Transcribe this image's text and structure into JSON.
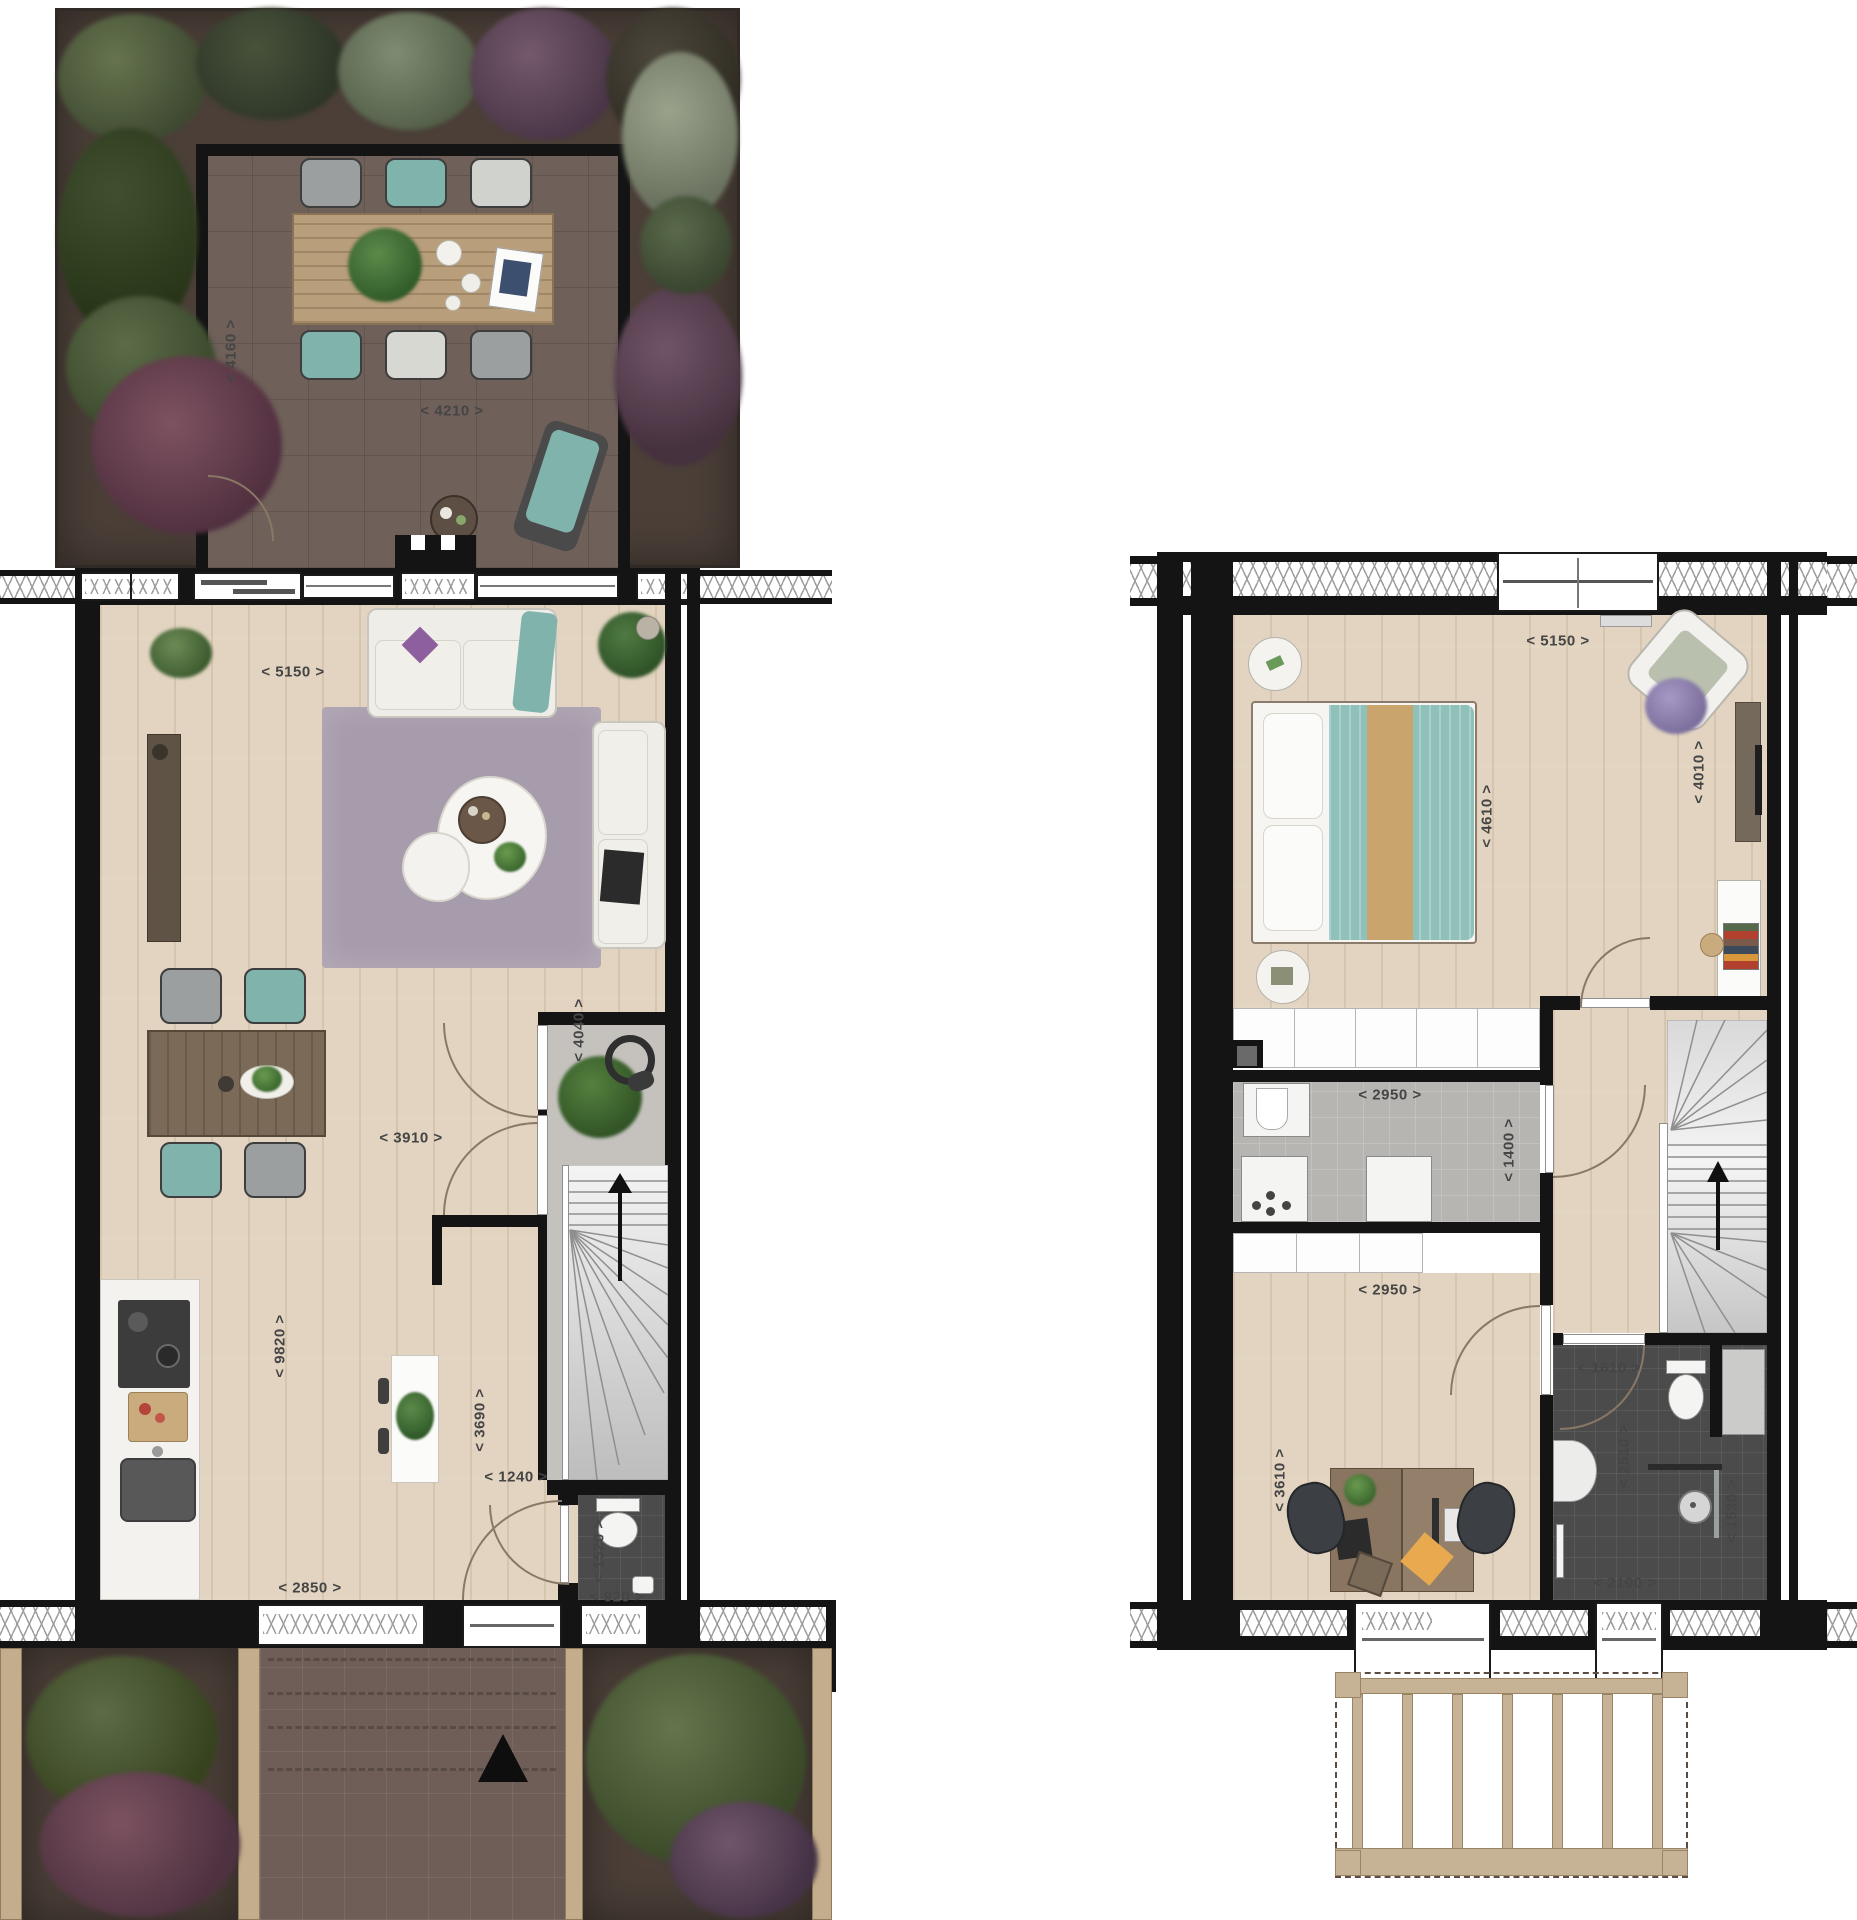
{
  "canvas": {
    "width": 1857,
    "height": 1920,
    "background": "#ffffff"
  },
  "palette": {
    "wall": "#141414",
    "wood_floor": "#e2d4c0",
    "terrace_tile": "#6f6059",
    "garden_soil": "#4b3f38",
    "front_path": "#6f5e57",
    "hall_floor": "#c5c2be",
    "utility_floor": "#b7b5b2",
    "bathroom_tile": "#4b4b4b",
    "rug": "#a79cab",
    "sofa_white": "#efede7",
    "accent_teal": "#84b7b0",
    "accent_purple": "#9c8fbc",
    "furniture_wood": "#7c6a58",
    "terrace_table_wood": "#b89e7b",
    "pergola_wood": "#c6b294",
    "kitchen_white": "#f3f2ef",
    "stair_tread": "#8f8f8f",
    "dim_text": "#454545",
    "runner_tan": "#c9a46c",
    "door_arc": "#8a7866"
  },
  "ground_floor": {
    "dims": [
      {
        "id": "terrace-depth",
        "text": "< 4160 >",
        "vertical": true
      },
      {
        "id": "terrace-width",
        "text": "< 4210 >",
        "vertical": false
      },
      {
        "id": "living-width",
        "text": "< 5150 >",
        "vertical": false
      },
      {
        "id": "living-depth",
        "text": "< 4040 >",
        "vertical": true
      },
      {
        "id": "dining-width",
        "text": "< 3910 >",
        "vertical": false
      },
      {
        "id": "floor-length",
        "text": "< 9820 >",
        "vertical": true
      },
      {
        "id": "corridor-depth",
        "text": "< 3690 >",
        "vertical": true
      },
      {
        "id": "corridor-width",
        "text": "< 1240 >",
        "vertical": false
      },
      {
        "id": "kitchen-width",
        "text": "< 2850 >",
        "vertical": false
      },
      {
        "id": "wc-depth",
        "text": "< 1520 >",
        "vertical": true
      },
      {
        "id": "wc-width",
        "text": "< 920 >",
        "vertical": false
      }
    ]
  },
  "upper_floor": {
    "dims": [
      {
        "id": "bedroom-width",
        "text": "< 5150 >",
        "vertical": false
      },
      {
        "id": "bedroom-depth",
        "text": "< 4610 >",
        "vertical": true
      },
      {
        "id": "bedroom-depth-right",
        "text": "< 4010 >",
        "vertical": true
      },
      {
        "id": "utility-width",
        "text": "< 2950 >",
        "vertical": false
      },
      {
        "id": "utility-depth",
        "text": "< 1400 >",
        "vertical": true
      },
      {
        "id": "study-width",
        "text": "< 2950 >",
        "vertical": false
      },
      {
        "id": "study-depth",
        "text": "< 3610 >",
        "vertical": true
      },
      {
        "id": "bathroom-width",
        "text": "< 1610 >",
        "vertical": false
      },
      {
        "id": "bathroom-depth",
        "text": "< 2510 >",
        "vertical": true
      },
      {
        "id": "shower-depth",
        "text": "< 1530 >",
        "vertical": true
      },
      {
        "id": "bathroom-width-lower",
        "text": "< 2100 >",
        "vertical": false
      }
    ]
  }
}
